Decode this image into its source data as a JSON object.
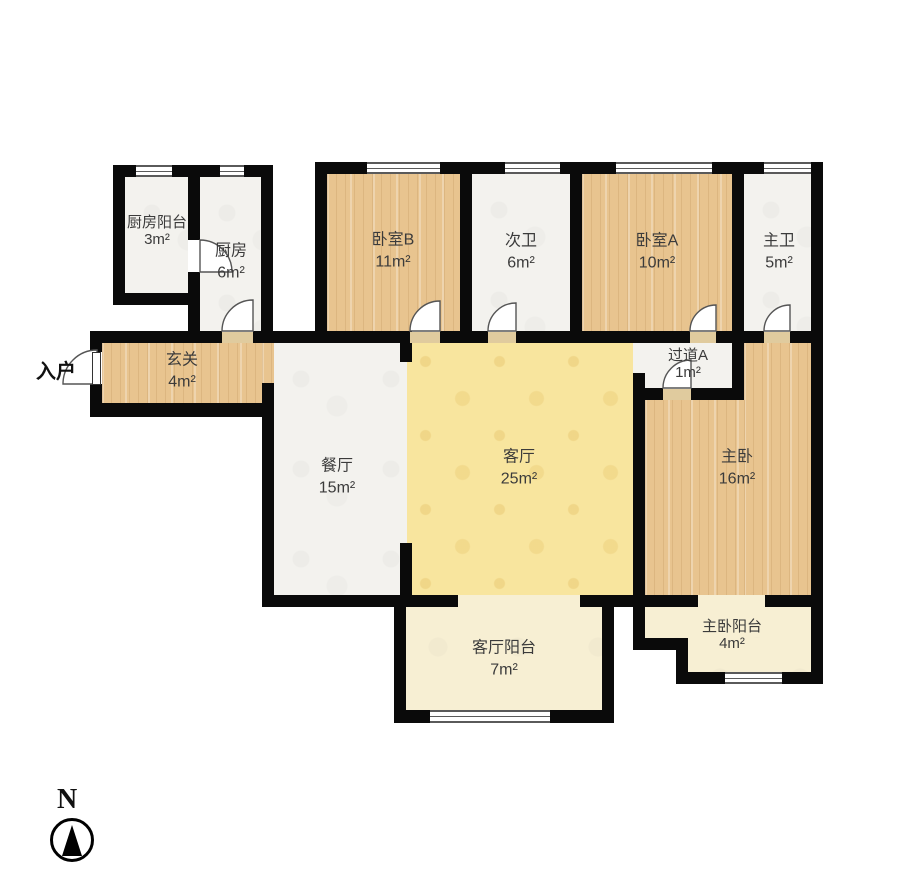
{
  "floorplan": {
    "rooms": [
      {
        "id": "kitchen-balcony",
        "label": "厨房阳台",
        "area": "3m²"
      },
      {
        "id": "kitchen",
        "label": "厨房",
        "area": "6m²"
      },
      {
        "id": "bedroom-b",
        "label": "卧室B",
        "area": "11m²"
      },
      {
        "id": "second-bathroom",
        "label": "次卫",
        "area": "6m²"
      },
      {
        "id": "bedroom-a",
        "label": "卧室A",
        "area": "10m²"
      },
      {
        "id": "master-bathroom",
        "label": "主卫",
        "area": "5m²"
      },
      {
        "id": "entry-hall",
        "label": "玄关",
        "area": "4m²"
      },
      {
        "id": "hallway-a",
        "label": "过道A",
        "area": "1m²"
      },
      {
        "id": "dining-room",
        "label": "餐厅",
        "area": "15m²"
      },
      {
        "id": "living-room",
        "label": "客厅",
        "area": "25m²"
      },
      {
        "id": "master-bedroom",
        "label": "主卧",
        "area": "16m²"
      },
      {
        "id": "living-balcony",
        "label": "客厅阳台",
        "area": "7m²"
      },
      {
        "id": "master-balcony",
        "label": "主卧阳台",
        "area": "4m²"
      }
    ],
    "annotations": {
      "entry": "入户",
      "compass_north": "N"
    },
    "colors": {
      "wall": "#0a0a0a",
      "wood_floor": "#e8c48f",
      "tile_floor": "#f3f2ee",
      "living_floor": "#f8e59e",
      "balcony_floor": "#f7efd3",
      "threshold": "#e0cb9e"
    }
  }
}
